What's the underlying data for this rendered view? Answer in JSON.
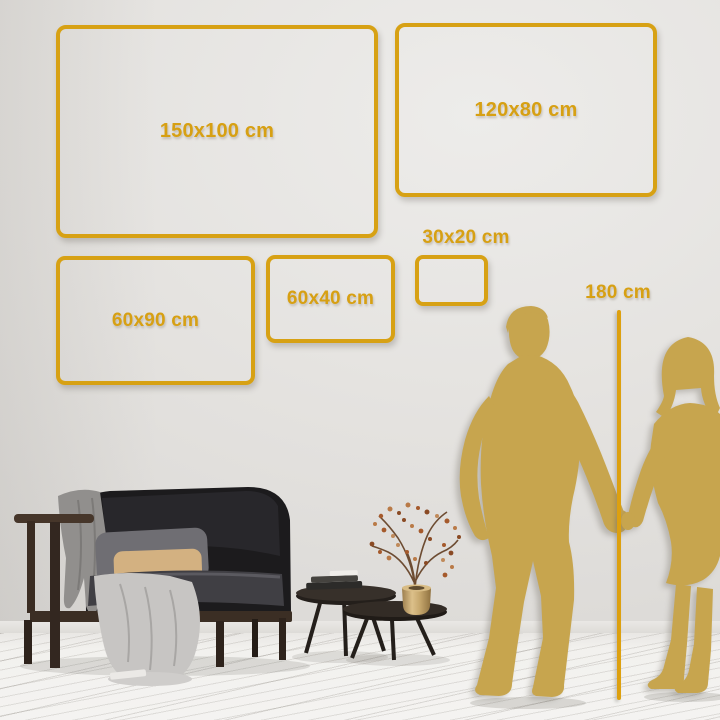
{
  "size_guide": {
    "frames": [
      {
        "id": "150x100",
        "label": "150x100 cm"
      },
      {
        "id": "120x80",
        "label": "120x80 cm"
      },
      {
        "id": "60x90",
        "label": "60x90 cm"
      },
      {
        "id": "60x40",
        "label": "60x40 cm"
      },
      {
        "id": "30x20",
        "label": "30x20 cm"
      }
    ],
    "height_marker_label": "180 cm"
  },
  "colors": {
    "accent_gold": "#d7a114",
    "silhouette_gold": "#c7a54e",
    "wall_gray": "#e3e1de",
    "floor_white": "#f3f2f0"
  },
  "icons": [
    {
      "name": "man-silhouette"
    },
    {
      "name": "woman-silhouette"
    },
    {
      "name": "height-ruler-line"
    },
    {
      "name": "sofa"
    },
    {
      "name": "blanket"
    },
    {
      "name": "pillows"
    },
    {
      "name": "coffee-tables"
    },
    {
      "name": "books"
    },
    {
      "name": "vase-with-dried-branch"
    }
  ]
}
